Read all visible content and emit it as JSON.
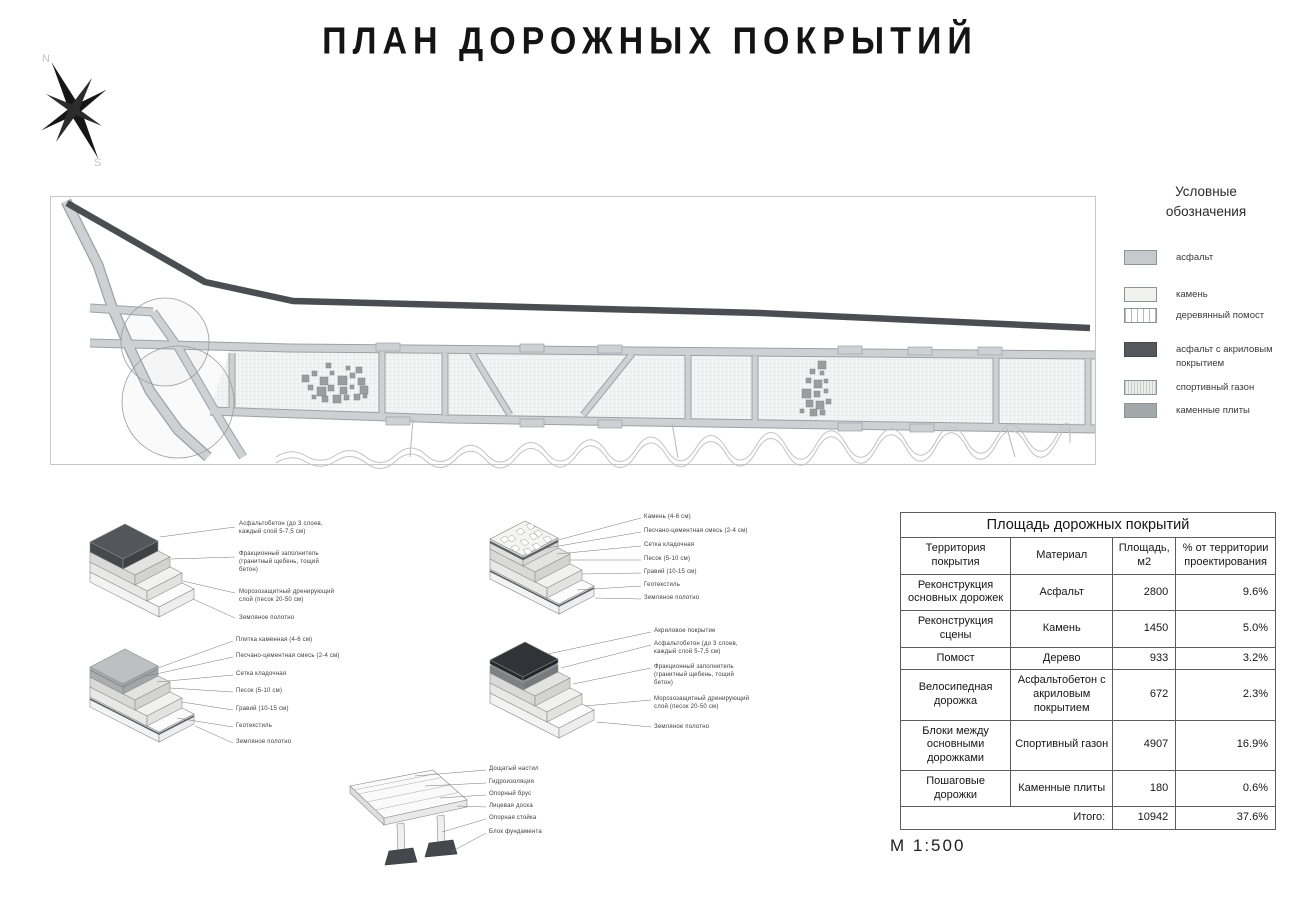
{
  "title": "ПЛАН ДОРОЖНЫХ ПОКРЫТИЙ",
  "scale": "М 1:500",
  "compass": {
    "n": "N",
    "s": "S"
  },
  "legend": {
    "title_line1": "Условные",
    "title_line2": "обозначения",
    "items": [
      {
        "name": "asphalt",
        "label": "асфальт",
        "color": "#c6cacd"
      },
      {
        "name": "stone",
        "label": "камень",
        "color": "#f1f1ef"
      },
      {
        "name": "wood-deck",
        "label": "деревянный помост",
        "color": "#ffffff"
      },
      {
        "name": "acrylic-asphalt",
        "label": "асфальт с акриловым покрытием",
        "color": "#55595d"
      },
      {
        "name": "sport-lawn",
        "label": "спортивный газон",
        "color": "#ededec"
      },
      {
        "name": "stone-plates",
        "label": "каменные плиты",
        "color": "#a2a7aa"
      }
    ]
  },
  "details": [
    {
      "name": "asphalt-pavement-section",
      "labels": [
        "Асфальтобетон (до 3 слоев, каждый слой 5-7,5 см)",
        "Фракционный заполнитель (гранитный щебень, тощий бетон)",
        "Морозозащитный дренирующий слой (песок 20-50 см)",
        "Земляное полотно"
      ]
    },
    {
      "name": "stone-pavement-section",
      "labels": [
        "Камень (4-6 см)",
        "Песчано-цементная смесь (2-4 см)",
        "Сетка кладочная",
        "Песок (5-10 см)",
        "Гравий (10-15 см)",
        "Геотекстиль",
        "Земляное полотно"
      ]
    },
    {
      "name": "stone-plate-section",
      "labels": [
        "Плитка каменная (4-6 см)",
        "Песчано-цементная смесь (2-4 см)",
        "Сетка кладочная",
        "Песок (5-10 см)",
        "Гравий (10-15 см)",
        "Геотекстиль",
        "Земляное полотно"
      ]
    },
    {
      "name": "acrylic-asphalt-section",
      "labels": [
        "Акриловое покрытие",
        "Асфальтобетон (до 3 слоев, каждый слой 5-7,5 см)",
        "Фракционный заполнитель (гранитный щебень, тощий бетон)",
        "Морозозащитный дренирующий слой (песок 20-50 см)",
        "Земляное полотно"
      ]
    },
    {
      "name": "wood-deck-section",
      "labels": [
        "Дощатый настил",
        "Гидроизоляция",
        "Опорный брус",
        "Лицевая доска",
        "Опорная стойка",
        "Блок фундамента"
      ]
    }
  ],
  "table": {
    "title": "Площадь дорожных покрытий",
    "headers": [
      "Территория покрытия",
      "Материал",
      "Площадь, м2",
      "% от территории проектирования"
    ],
    "rows": [
      [
        "Реконструкция основных дорожек",
        "Асфальт",
        "2800",
        "9.6%"
      ],
      [
        "Реконструкция сцены",
        "Камень",
        "1450",
        "5.0%"
      ],
      [
        "Помост",
        "Дерево",
        "933",
        "3.2%"
      ],
      [
        "Велосипедная дорожка",
        "Асфальтобетон с акриловым покрытием",
        "672",
        "2.3%"
      ],
      [
        "Блоки между основными дорожками",
        "Спортивный газон",
        "4907",
        "16.9%"
      ],
      [
        "Пошаговые дорожки",
        "Каменные плиты",
        "180",
        "0.6%"
      ]
    ],
    "total_label": "Итого:",
    "total_area": "10942",
    "total_percent": "37.6%"
  },
  "colors": {
    "bike_path": "#4a4e53",
    "asphalt_road": "#cdd1d4",
    "road_edge": "#9ba1a5"
  }
}
